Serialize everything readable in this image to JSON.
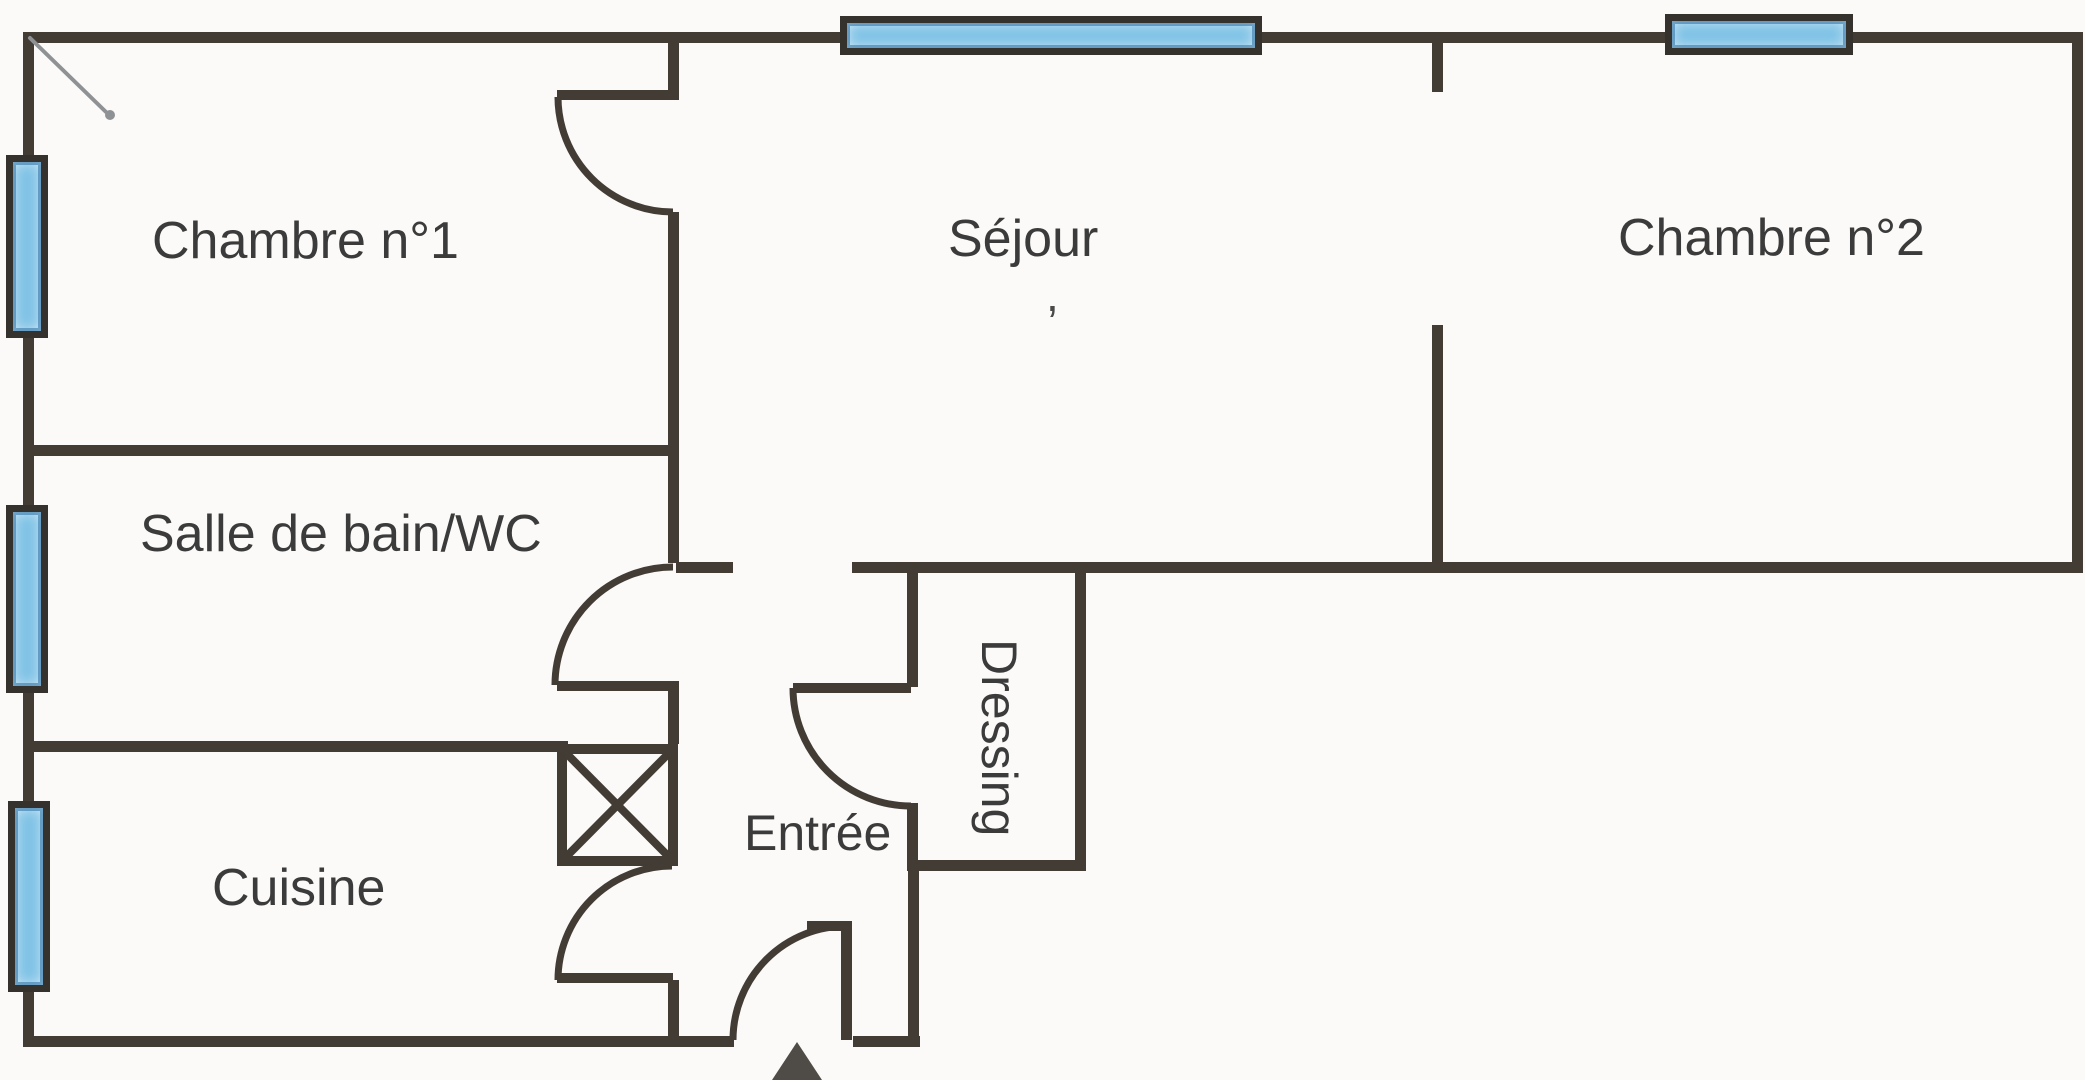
{
  "document": {
    "type": "scanned apartment floor plan",
    "language": "fr"
  },
  "rooms": {
    "chambre1": {
      "label": "Chambre n°1"
    },
    "sejour": {
      "label": "Séjour"
    },
    "chambre2": {
      "label": "Chambre n°2"
    },
    "salle_de_bain": {
      "label": "Salle de bain/WC"
    },
    "dressing": {
      "label": "Dressing"
    },
    "entree": {
      "label": "Entrée"
    },
    "cuisine": {
      "label": "Cuisine"
    }
  },
  "features": {
    "windows": [
      "window-left-1",
      "window-left-2",
      "window-left-3",
      "window-top-sejour",
      "window-top-chambre2"
    ],
    "doors": [
      "door-chambre1",
      "door-salle-de-bain",
      "door-dressing",
      "door-cuisine",
      "door-entree-front"
    ],
    "duct_shaft": "x-box",
    "entrance_arrow": "up-arrow"
  },
  "marks": {
    "apostrophe": ","
  },
  "colors": {
    "wall": "#423c35",
    "window_border": "#35312c",
    "window_fill": "#7fc2e6",
    "paper": "#fbfaf8",
    "text": "#3b3b3b",
    "arrow": "#4f4b47",
    "pencil": "#8f9294"
  }
}
